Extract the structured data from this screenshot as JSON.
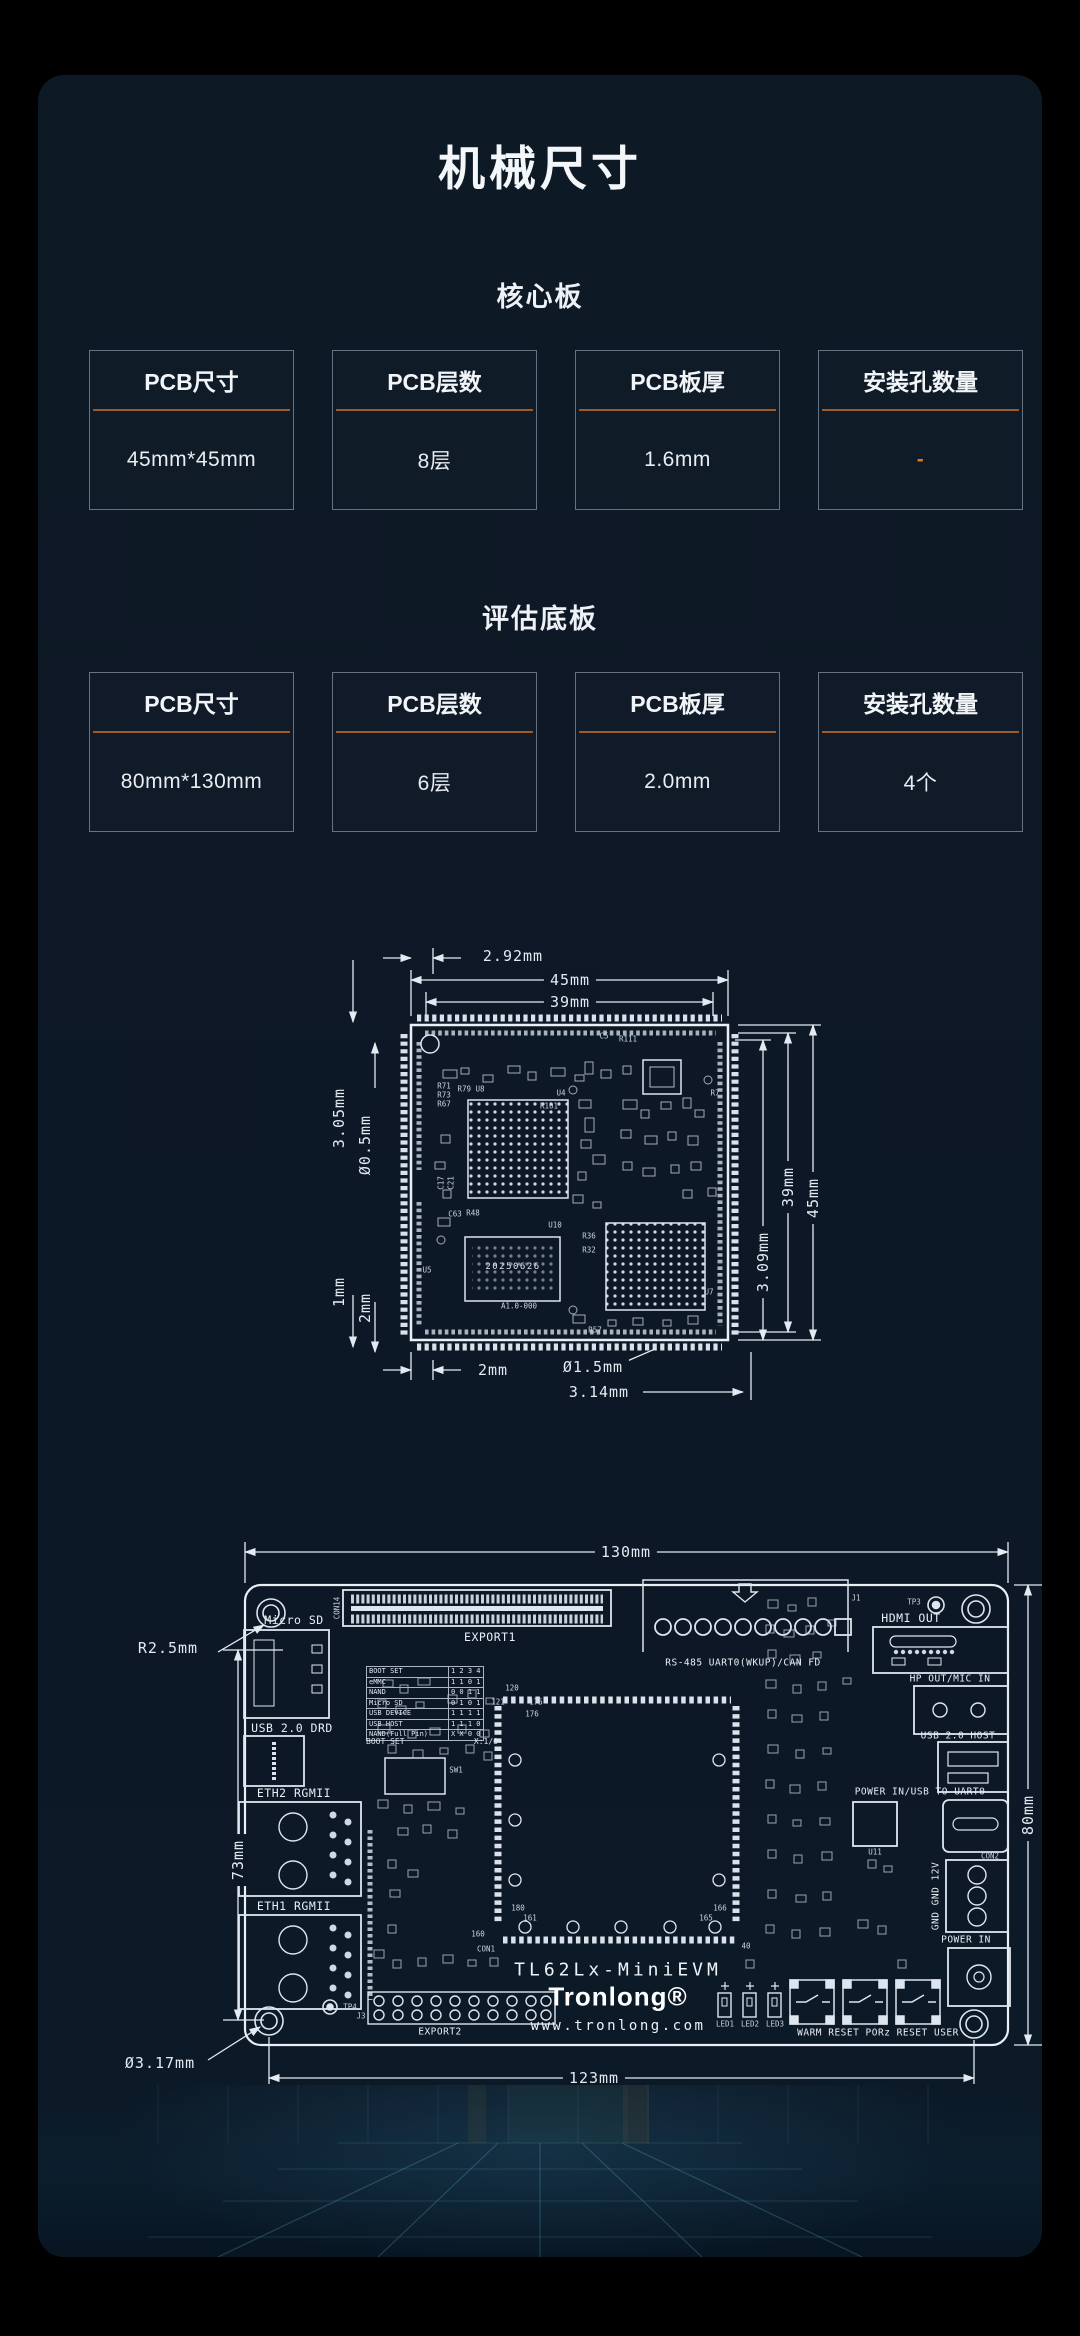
{
  "page": {
    "title": "机械尺寸"
  },
  "sections": {
    "core": {
      "title": "核心板",
      "cards": [
        {
          "label": "PCB尺寸",
          "value": "45mm*45mm"
        },
        {
          "label": "PCB层数",
          "value": "8层"
        },
        {
          "label": "PCB板厚",
          "value": "1.6mm"
        },
        {
          "label": "安装孔数量",
          "value": "-",
          "cls": "accent"
        }
      ]
    },
    "base": {
      "title": "评估底板",
      "cards": [
        {
          "label": "PCB尺寸",
          "value": "80mm*130mm"
        },
        {
          "label": "PCB层数",
          "value": "6层"
        },
        {
          "label": "PCB板厚",
          "value": "2.0mm"
        },
        {
          "label": "安装孔数量",
          "value": "4个"
        }
      ]
    }
  },
  "colors": {
    "accent_orange": "#d97a1e",
    "divider": "#9d5b28",
    "panel_bg": "#0d1826",
    "line": "#e3eaf1"
  },
  "core_drawing": {
    "dim_labels": [
      {
        "text": "2.92mm",
        "x": 190,
        "y": 16,
        "cls": "dim"
      },
      {
        "text": "45mm",
        "x": 247,
        "y": 40,
        "cls": "dim bg"
      },
      {
        "text": "39mm",
        "x": 247,
        "y": 62,
        "cls": "dim bg"
      },
      {
        "text": "3.05mm",
        "x": 16,
        "y": 178,
        "rot": -90,
        "cls": "dim"
      },
      {
        "text": "Ø0.5mm",
        "x": 42,
        "y": 205,
        "rot": -90,
        "cls": "dim"
      },
      {
        "text": "1mm",
        "x": 16,
        "y": 352,
        "rot": -90,
        "cls": "dim"
      },
      {
        "text": "2mm",
        "x": 42,
        "y": 368,
        "rot": -90,
        "cls": "dim"
      },
      {
        "text": "2mm",
        "x": 170,
        "y": 430,
        "cls": "dim bg"
      },
      {
        "text": "Ø1.5mm",
        "x": 270,
        "y": 427,
        "cls": "dim bg"
      },
      {
        "text": "3.14mm",
        "x": 276,
        "y": 452,
        "cls": "dim bg"
      },
      {
        "text": "3.09mm",
        "x": 440,
        "y": 322,
        "rot": -90,
        "cls": "dim bg"
      },
      {
        "text": "39mm",
        "x": 465,
        "y": 247,
        "rot": -90,
        "cls": "dim bg"
      },
      {
        "text": "45mm",
        "x": 490,
        "y": 258,
        "rot": -90,
        "cls": "dim bg"
      }
    ],
    "chip_texts": [
      {
        "text": "20250626",
        "x": 190,
        "y": 327,
        "cls": "chip"
      },
      {
        "text": "A1.0-000",
        "x": 196,
        "y": 366,
        "cls": "ref"
      }
    ],
    "ref_labels": [
      {
        "text": "R71",
        "x": 121,
        "y": 146,
        "cls": "ref"
      },
      {
        "text": "R73",
        "x": 121,
        "y": 155,
        "cls": "ref"
      },
      {
        "text": "R67",
        "x": 121,
        "y": 164,
        "cls": "ref"
      },
      {
        "text": "R79 U8",
        "x": 148,
        "y": 149,
        "cls": "ref"
      },
      {
        "text": "U4",
        "x": 238,
        "y": 153,
        "cls": "ref"
      },
      {
        "text": "R101",
        "x": 226,
        "y": 166,
        "cls": "ref"
      },
      {
        "text": "C17",
        "x": 118,
        "y": 243,
        "rot": -90,
        "cls": "ref"
      },
      {
        "text": "C21",
        "x": 128,
        "y": 243,
        "rot": -90,
        "cls": "ref"
      },
      {
        "text": "C63",
        "x": 132,
        "y": 274,
        "cls": "ref"
      },
      {
        "text": "R48",
        "x": 150,
        "y": 273,
        "cls": "ref"
      },
      {
        "text": "U10",
        "x": 232,
        "y": 285,
        "cls": "ref"
      },
      {
        "text": "U5",
        "x": 104,
        "y": 330,
        "cls": "ref"
      },
      {
        "text": "R36",
        "x": 266,
        "y": 296,
        "cls": "ref"
      },
      {
        "text": "R32",
        "x": 266,
        "y": 310,
        "cls": "ref"
      },
      {
        "text": "U7",
        "x": 386,
        "y": 352,
        "cls": "ref"
      },
      {
        "text": "R57",
        "x": 272,
        "y": 390,
        "cls": "ref"
      },
      {
        "text": "R7",
        "x": 392,
        "y": 153,
        "cls": "ref"
      },
      {
        "text": "C5",
        "x": 281,
        "y": 96,
        "cls": "ref"
      },
      {
        "text": "R111",
        "x": 305,
        "y": 99,
        "cls": "ref"
      }
    ]
  },
  "eval_drawing": {
    "dim_labels": [
      {
        "text": "130mm",
        "x": 548,
        "y": 22,
        "cls": "dim bg"
      },
      {
        "text": "123mm",
        "x": 516,
        "y": 548,
        "cls": "dim bg"
      },
      {
        "text": "73mm",
        "x": 160,
        "y": 330,
        "rot": -90,
        "cls": "dim bg"
      },
      {
        "text": "80mm",
        "x": 950,
        "y": 285,
        "rot": -90,
        "cls": "dim bg"
      },
      {
        "text": "R2.5mm",
        "x": 90,
        "y": 118,
        "cls": "dim"
      },
      {
        "text": "Ø3.17mm",
        "x": 82,
        "y": 533,
        "cls": "dim"
      }
    ],
    "port_labels": [
      {
        "text": "Micro SD",
        "x": 216,
        "y": 90,
        "cls": "port"
      },
      {
        "text": "USB 2.0 DRD",
        "x": 214,
        "y": 198,
        "cls": "port"
      },
      {
        "text": "ETH2 RGMII",
        "x": 216,
        "y": 263,
        "cls": "port"
      },
      {
        "text": "ETH1 RGMII",
        "x": 216,
        "y": 376,
        "cls": "port"
      },
      {
        "text": "EXPORT1",
        "x": 412,
        "y": 107,
        "cls": "port"
      },
      {
        "text": "RS-485 UART0(WKUP)/CAN FD",
        "x": 665,
        "y": 133,
        "cls": "port sm"
      },
      {
        "text": "HDMI OUT",
        "x": 833,
        "y": 88,
        "cls": "port"
      },
      {
        "text": "HP OUT/MIC IN",
        "x": 872,
        "y": 149,
        "cls": "port sm"
      },
      {
        "text": "USB 2.0 HOST",
        "x": 880,
        "y": 206,
        "cls": "port sm"
      },
      {
        "text": "POWER IN/USB TO UART0",
        "x": 842,
        "y": 262,
        "cls": "port sm"
      },
      {
        "text": "GND GND 12V",
        "x": 858,
        "y": 366,
        "rot": -90,
        "cls": "port sm"
      },
      {
        "text": "POWER IN",
        "x": 888,
        "y": 410,
        "cls": "port sm"
      },
      {
        "text": "EXPORT2",
        "x": 362,
        "y": 502,
        "cls": "port sm"
      },
      {
        "text": "WARM RESET PORz RESET USER",
        "x": 800,
        "y": 503,
        "cls": "port sm"
      }
    ],
    "ref_labels": [
      {
        "text": "TP3",
        "x": 836,
        "y": 72,
        "cls": "ref"
      },
      {
        "text": "TP4",
        "x": 272,
        "y": 477,
        "cls": "ref"
      },
      {
        "text": "SW1",
        "x": 378,
        "y": 240,
        "cls": "ref"
      },
      {
        "text": "CON1",
        "x": 408,
        "y": 419,
        "cls": "ref"
      },
      {
        "text": "J1",
        "x": 778,
        "y": 68,
        "cls": "ref"
      },
      {
        "text": "J3",
        "x": 283,
        "y": 486,
        "cls": "ref"
      },
      {
        "text": "CON14",
        "x": 259,
        "y": 78,
        "rot": -90,
        "cls": "ref"
      },
      {
        "text": "U11",
        "x": 797,
        "y": 322,
        "cls": "ref"
      },
      {
        "text": "CON2",
        "x": 912,
        "y": 326,
        "cls": "ref"
      },
      {
        "text": "160",
        "x": 400,
        "y": 404,
        "cls": "ref"
      },
      {
        "text": "161",
        "x": 452,
        "y": 388,
        "cls": "ref"
      },
      {
        "text": "180",
        "x": 440,
        "y": 378,
        "cls": "ref"
      },
      {
        "text": "165",
        "x": 628,
        "y": 388,
        "cls": "ref"
      },
      {
        "text": "166",
        "x": 642,
        "y": 378,
        "cls": "ref"
      },
      {
        "text": "40",
        "x": 668,
        "y": 416,
        "cls": "ref"
      },
      {
        "text": "120",
        "x": 434,
        "y": 158,
        "cls": "ref"
      },
      {
        "text": "121",
        "x": 420,
        "y": 172,
        "cls": "ref"
      },
      {
        "text": "175",
        "x": 458,
        "y": 172,
        "cls": "ref"
      },
      {
        "text": "176",
        "x": 454,
        "y": 184,
        "cls": "ref"
      }
    ],
    "led_labels": [
      {
        "text": "LED1",
        "x": 647,
        "y": 494,
        "cls": "ref"
      },
      {
        "text": "LED2",
        "x": 672,
        "y": 494,
        "cls": "ref"
      },
      {
        "text": "LED3",
        "x": 697,
        "y": 494,
        "cls": "ref"
      }
    ],
    "brand": {
      "model": "TL62Lx-MiniEVM",
      "logo": "Tronlong®",
      "url": "www.tronlong.com"
    },
    "boot_table": {
      "rows": [
        [
          "BOOT SET",
          "1 2 3 4"
        ],
        [
          "eMMC",
          "1 1 0 1"
        ],
        [
          "NAND",
          "0 0 1 1"
        ],
        [
          "Micro SD",
          "0 1 0 1"
        ],
        [
          "USB DEVICE",
          "1 1 1 1"
        ],
        [
          "USB HOST",
          "1 1 1 0"
        ],
        [
          "NAND(Full Pin)",
          "X X 0 0"
        ]
      ],
      "footer_left": "BOOT SET",
      "footer_right": "X:1/0"
    }
  }
}
